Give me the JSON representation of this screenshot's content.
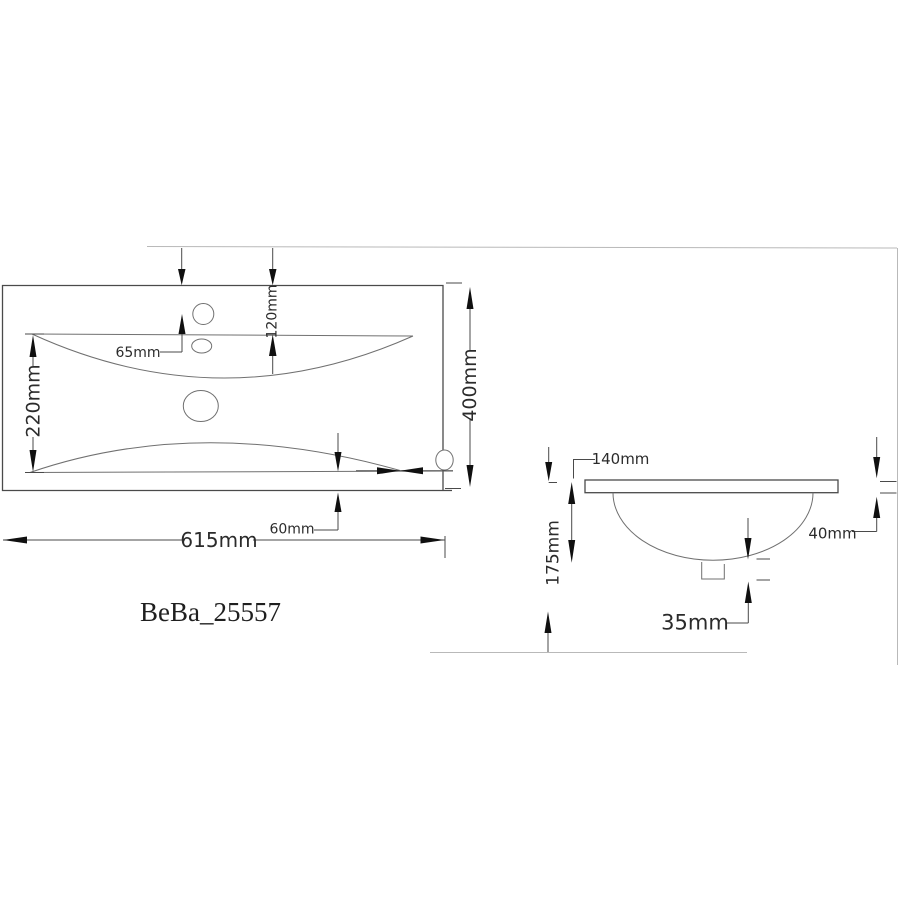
{
  "title": "BeBa_25557",
  "top_view": {
    "dimensions": {
      "width": "615mm",
      "height": "400mm",
      "basin_inner_length": "220mm",
      "rim_to_basin_top": "120mm",
      "hole_center_offset": "65mm",
      "basin_to_front_edge": "60mm"
    }
  },
  "side_view": {
    "dimensions": {
      "basin_depth": "140mm",
      "total_height": "175mm",
      "rim_thickness": "40mm",
      "drain_height": "35mm"
    }
  },
  "colors": {
    "background": "#ffffff",
    "line": "#4a4a4a",
    "thin_line": "#707070",
    "faint_line": "#b9b9b9",
    "arrow": "#101010",
    "text": "#2b2b2b"
  }
}
